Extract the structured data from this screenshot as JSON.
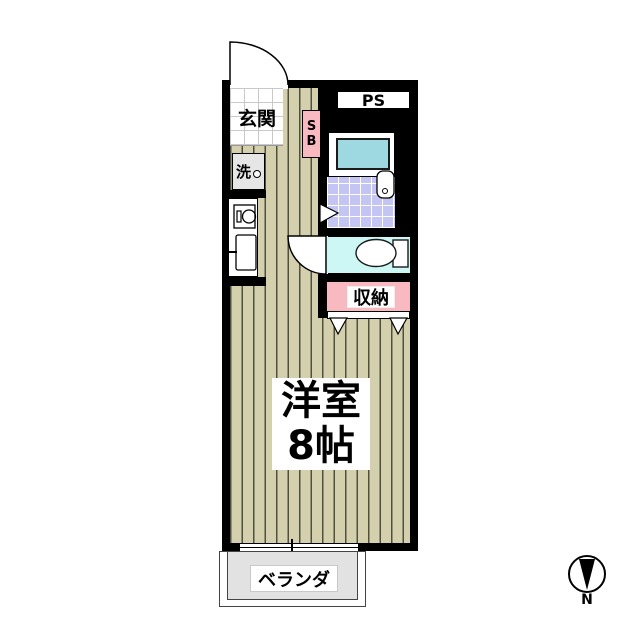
{
  "floorplan": {
    "entrance": {
      "label": "玄関"
    },
    "pipe_space": {
      "label": "PS"
    },
    "shoe_box": {
      "letters": [
        "S",
        "B"
      ]
    },
    "washer": {
      "label": "洗"
    },
    "storage": {
      "label": "収納"
    },
    "main_room": {
      "name": "洋室",
      "size": "8帖"
    },
    "balcony": {
      "label": "ベランダ"
    },
    "compass": {
      "label": "N"
    },
    "colors": {
      "wall": "#000000",
      "flooring": "#d4d0ae",
      "flooring_stripe": "#50503e",
      "genkan_tile": "#ffffff",
      "bath_tile": "#c5c5f3",
      "bathtub": "#9ed9e2",
      "toilet_room": "#ccf7f5",
      "storage_pink": "#f9b9c1",
      "shoe_box_pink": "#f9b9c1",
      "washer_gray": "#e6e6e6",
      "balcony_gray": "#e2e2e2"
    },
    "icons": {
      "entrance-door-icon": "quarter-arc-swing",
      "toilet-door-icon": "quarter-arc-swing",
      "bathroom-door-icon": "triangle-mark",
      "closet-door-icon": "double-triangle-mark",
      "bathtub-icon": "bordered-rect",
      "bathroom-sink-icon": "rounded-rect-with-drain-circle",
      "toilet-icon": "bowl-ellipse-with-tank-rect",
      "washing-machine-icon": "box-with-faucet-circle",
      "kitchen-burner-icon": "circle-in-box",
      "kitchen-sink-icon": "rect-with-faucet-line",
      "window-icon": "sliding-window-cross",
      "north-arrow-icon": "circle-with-down-wedge"
    }
  }
}
